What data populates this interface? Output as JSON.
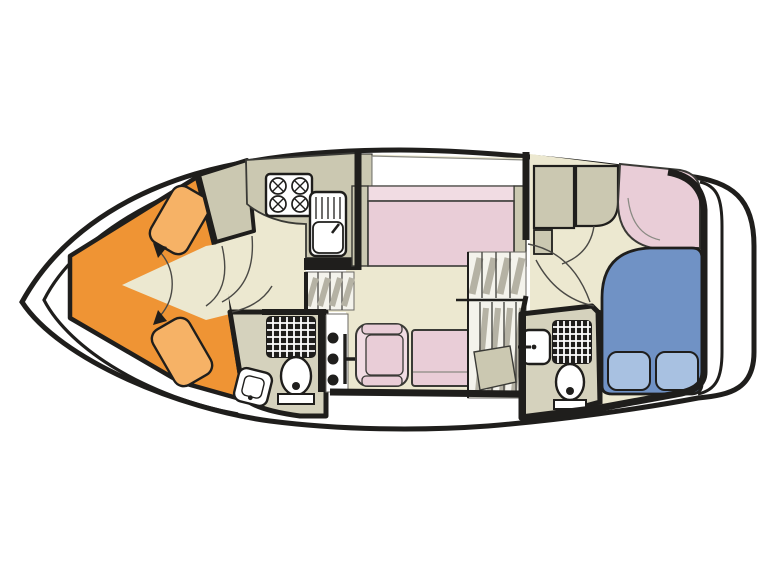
{
  "plan": {
    "title": "Motor cruiser deck plan",
    "orientation": "bow-left-stern-right",
    "rooms": [
      {
        "id": "bow-cabin",
        "name": "Bow cabin with V-berth",
        "furniture": [
          "v-berth-port",
          "v-berth-starboard",
          "berth-infill-arrows"
        ]
      },
      {
        "id": "galley",
        "name": "Galley",
        "furniture": [
          "worktop",
          "four-burner-hob",
          "sink-with-drainer",
          "companionway-steps"
        ]
      },
      {
        "id": "forward-bathroom",
        "name": "Forward bathroom",
        "furniture": [
          "shower",
          "toilet",
          "washbasin"
        ]
      },
      {
        "id": "saloon",
        "name": "Saloon",
        "furniture": [
          "bench-sofa",
          "sideboard-shelf",
          "armchair",
          "table-seat",
          "helm-panel",
          "staircase-to-deck"
        ]
      },
      {
        "id": "aft-cabin",
        "name": "Aft cabin",
        "furniture": [
          "double-bed",
          "pillows",
          "corner-sofa",
          "wardrobe"
        ]
      },
      {
        "id": "aft-bathroom",
        "name": "Aft bathroom",
        "furniture": [
          "shower",
          "toilet",
          "washbasin"
        ]
      },
      {
        "id": "aft-deck",
        "name": "Aft deck with transom"
      }
    ]
  },
  "palette": {
    "outline": "#1f1e1c",
    "white": "#ffffff",
    "cream": "#ece8d0",
    "taupe": "#cbc8b1",
    "bath": "#d5d2bd",
    "orange": "#ef9434",
    "orange_light": "#f6b266",
    "pink": "#e9cdd7",
    "pink_light": "#f1dce3",
    "blue": "#7092c5",
    "blue_light": "#a8c1e1",
    "step_gray": "#b5b2a4",
    "stair_base": "#f4f3ec",
    "black": "#1f1e1c"
  }
}
